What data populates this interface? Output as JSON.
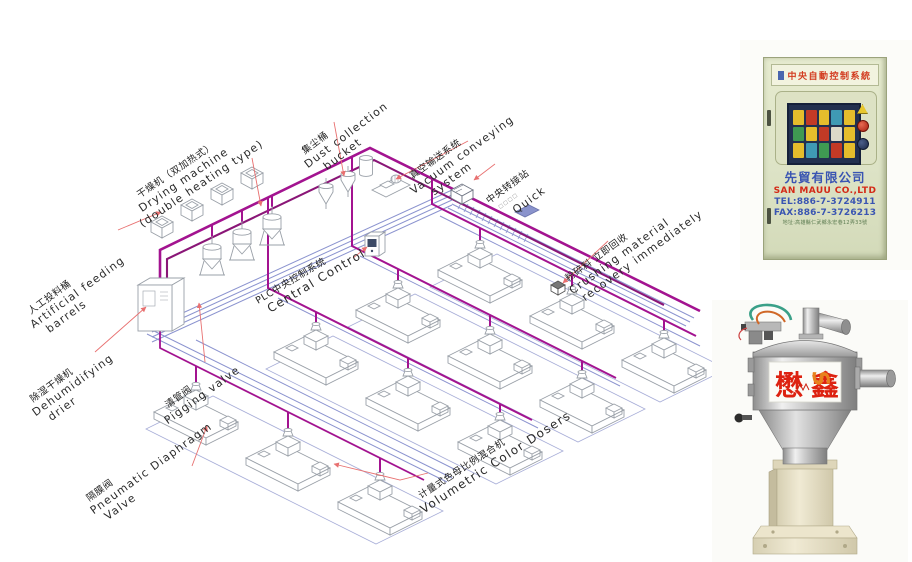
{
  "diagram": {
    "labels": {
      "feeding": {
        "zh": "人工投料桶",
        "en1": "Artificial feeding",
        "en2": "barrels"
      },
      "drying": {
        "zh": "干燥机（双加热式）",
        "en1": "Drying machine",
        "en2": "(double heating type)"
      },
      "dust": {
        "zh": "集尘桶",
        "en1": "Dust collection",
        "en2": "bucket"
      },
      "vacuum": {
        "zh": "真空输送系统",
        "en1": "Vacuum conveying",
        "en2": "system"
      },
      "transfer": {
        "zh": "中央转接站",
        "sub": "□□□□",
        "en1": "Quick"
      },
      "plc": {
        "zh": "PLC中央控制系统",
        "en1": "Central Control"
      },
      "crushing": {
        "zh": "粉碎料 立即回收",
        "en1": "Crushing material",
        "en2": "recovery immediately"
      },
      "dehumid": {
        "zh": "除湿干燥机",
        "en1": "Dehumidifying",
        "en2": "drier"
      },
      "pigging": {
        "zh": "清管阀",
        "en1": "Pigging valve"
      },
      "diaphragm": {
        "zh": "隔膜阀",
        "en1": "Pneumatic Diaphragm",
        "en2": "Valve"
      },
      "dosers": {
        "zh": "计量式色母比例混合机",
        "en1": "Volumetric Color Dosers"
      }
    },
    "colors": {
      "pipe": "#a31390",
      "pipe_dark": "#8a1677",
      "return_line": "#8b93cf",
      "leader": "#e87070",
      "outline": "#9aa0a8"
    }
  },
  "cabinet": {
    "sign": "中央自動控制系統",
    "company_zh": "先貿有限公司",
    "company_en": "SAN MAUU CO.,LTD",
    "tel": "TEL:886-7-3724911",
    "fax": "FAX:886-7-3726213",
    "address": "地址:高雄縣仁武鄉永宏巷12弄33號"
  },
  "hopper": {
    "brand_left": "懋",
    "brand_right": "鑫",
    "logo": "S"
  }
}
